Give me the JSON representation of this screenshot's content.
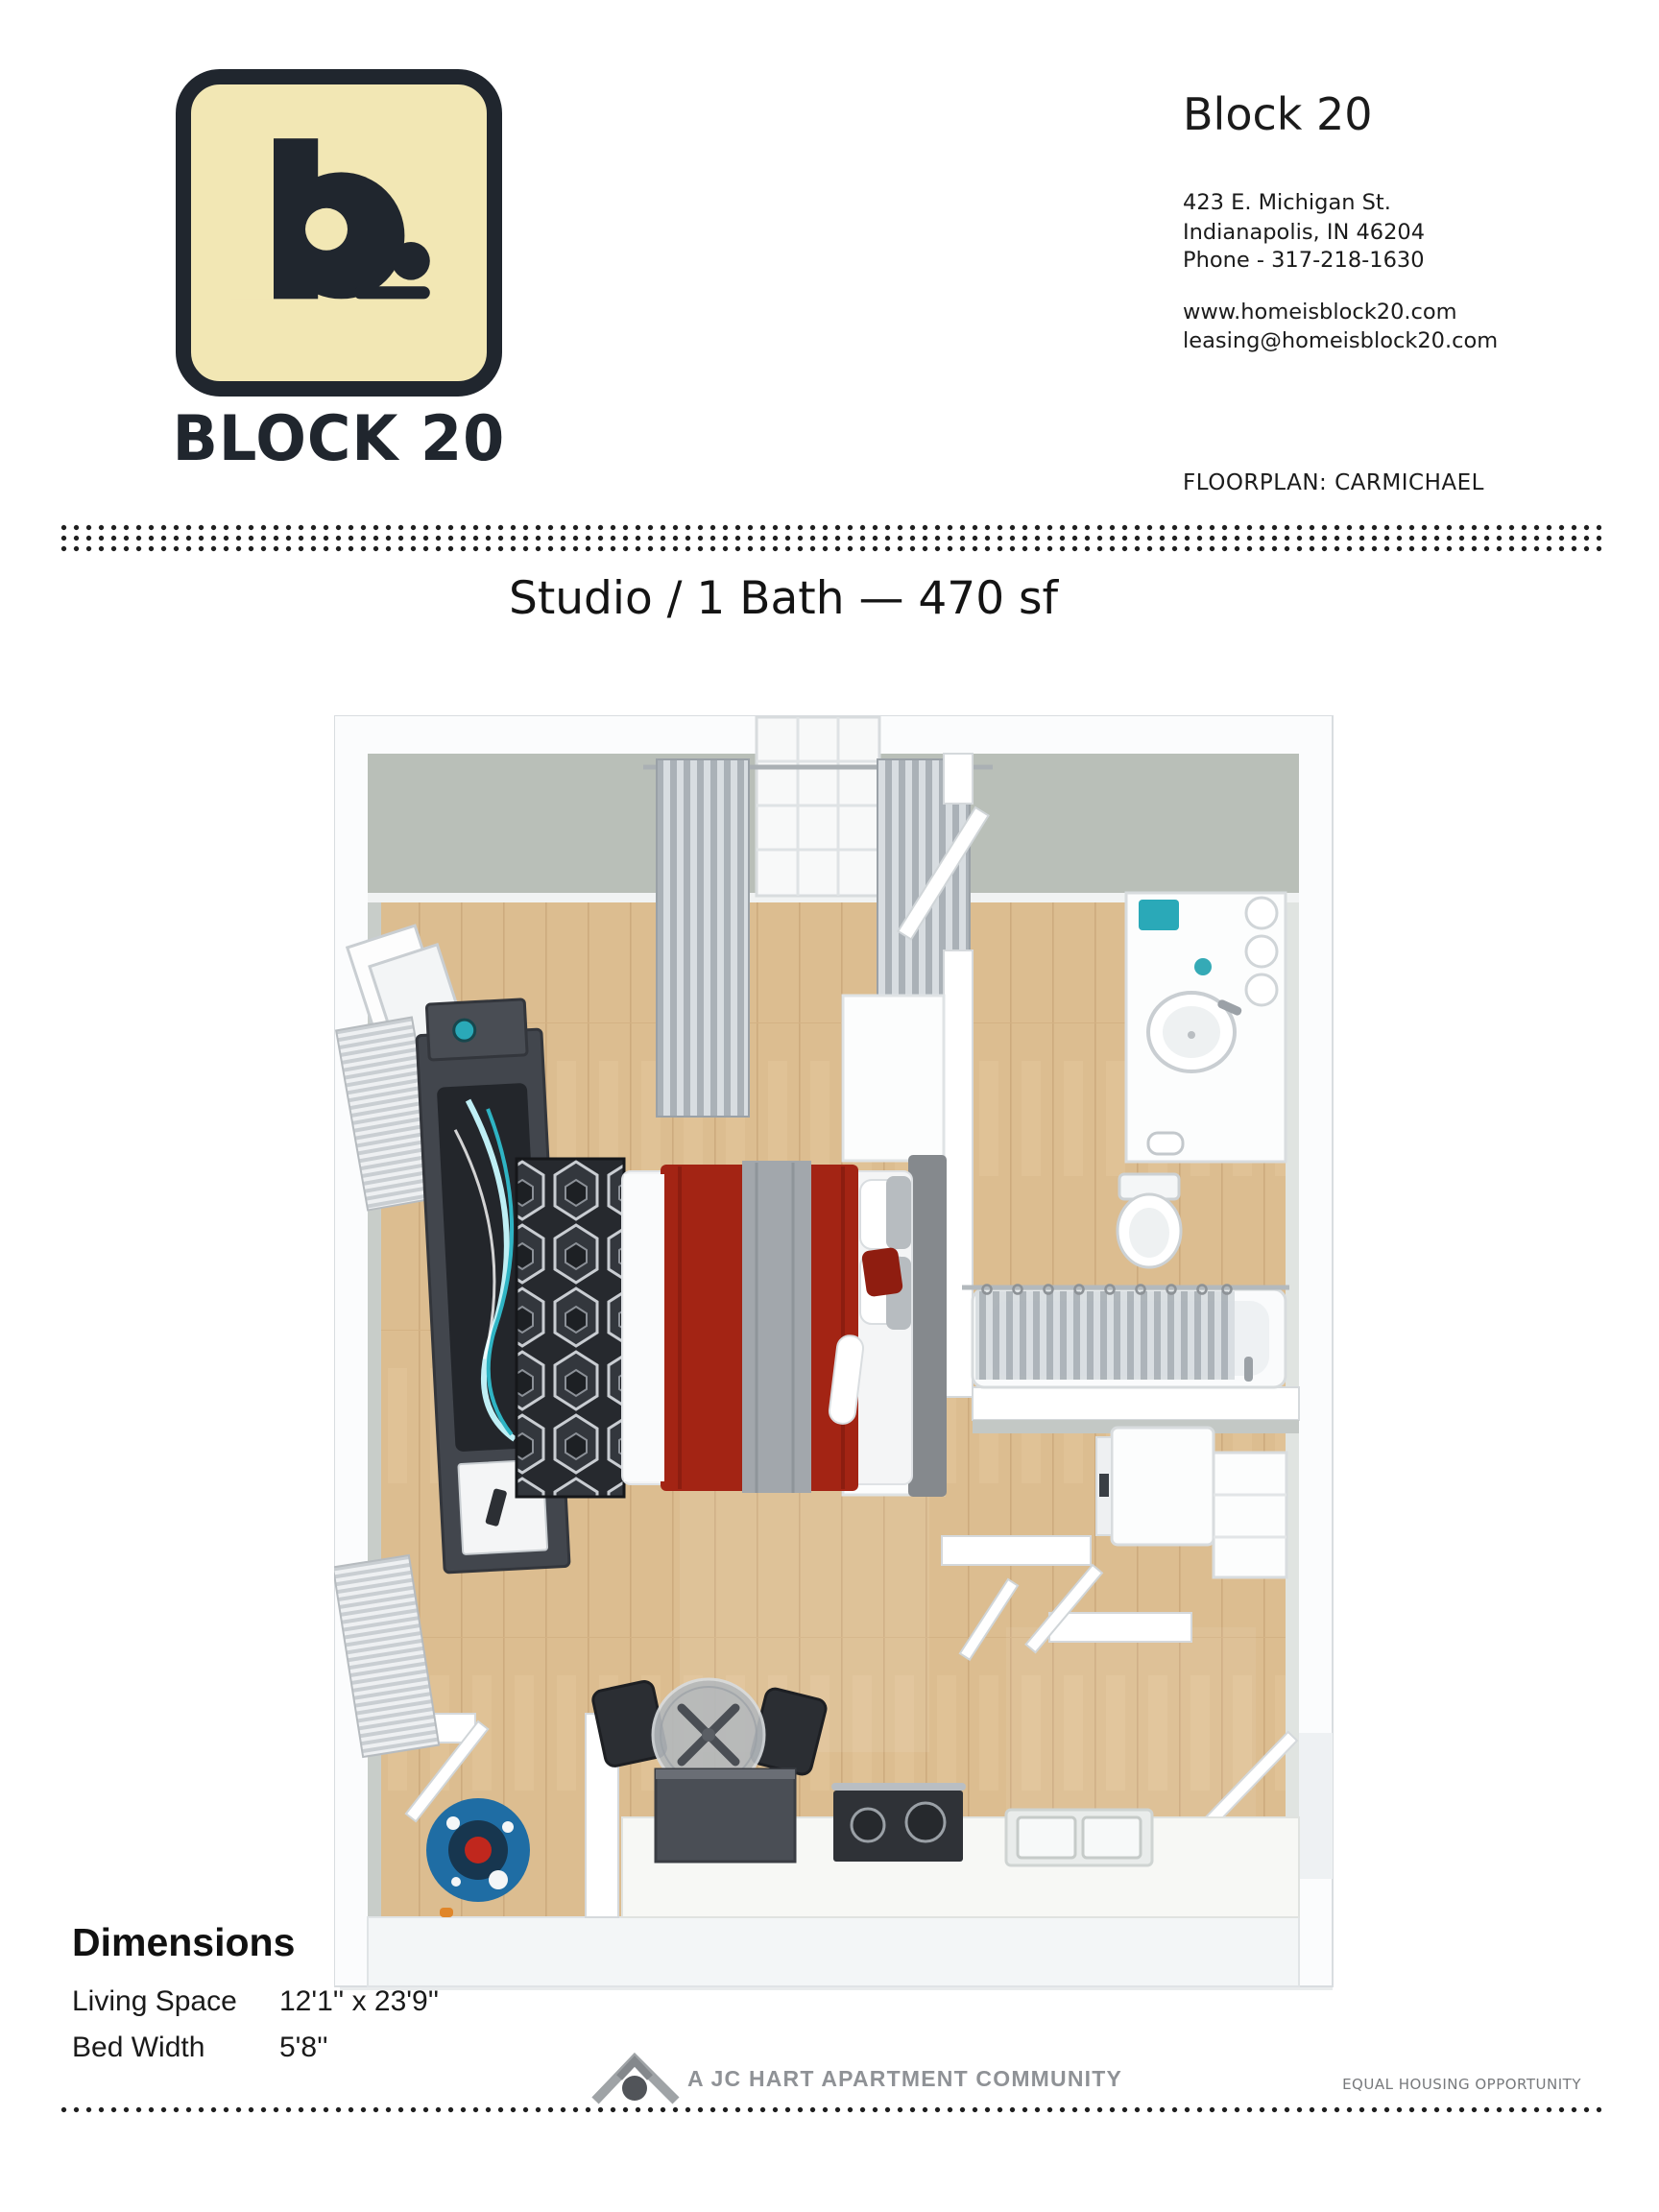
{
  "header": {
    "logo": {
      "wordmark": "BLOCK 20",
      "glyph": "b."
    },
    "property_name": "Block 20",
    "address_line1": "423 E. Michigan St.",
    "address_line2": "Indianapolis, IN 46204",
    "phone": "Phone - 317-218-1630",
    "website": "www.homeisblock20.com",
    "email": "leasing@homeisblock20.com",
    "floorplan_label": "FLOORPLAN: CARMICHAEL"
  },
  "plan": {
    "title": "Studio / 1 Bath — 470 sf"
  },
  "dimensions": {
    "heading": "Dimensions",
    "rows": [
      {
        "label": "Living Space",
        "value": "12'1'' x 23'9''"
      },
      {
        "label": "Bed Width",
        "value": "5'8''"
      }
    ]
  },
  "footer": {
    "community_text": "A JC HART APARTMENT COMMUNITY",
    "equal_housing": "EQUAL HOUSING OPPORTUNITY"
  },
  "colors": {
    "brand_cream": "#f2e7b4",
    "brand_dark": "#20262e",
    "text_gray": "#8f9296",
    "wood": "#dcbd90",
    "wall_face": "#b9bfb8",
    "bed_red": "#a32414",
    "rug_blue": "#1f6da4",
    "accent_teal": "#2aa9b8"
  }
}
